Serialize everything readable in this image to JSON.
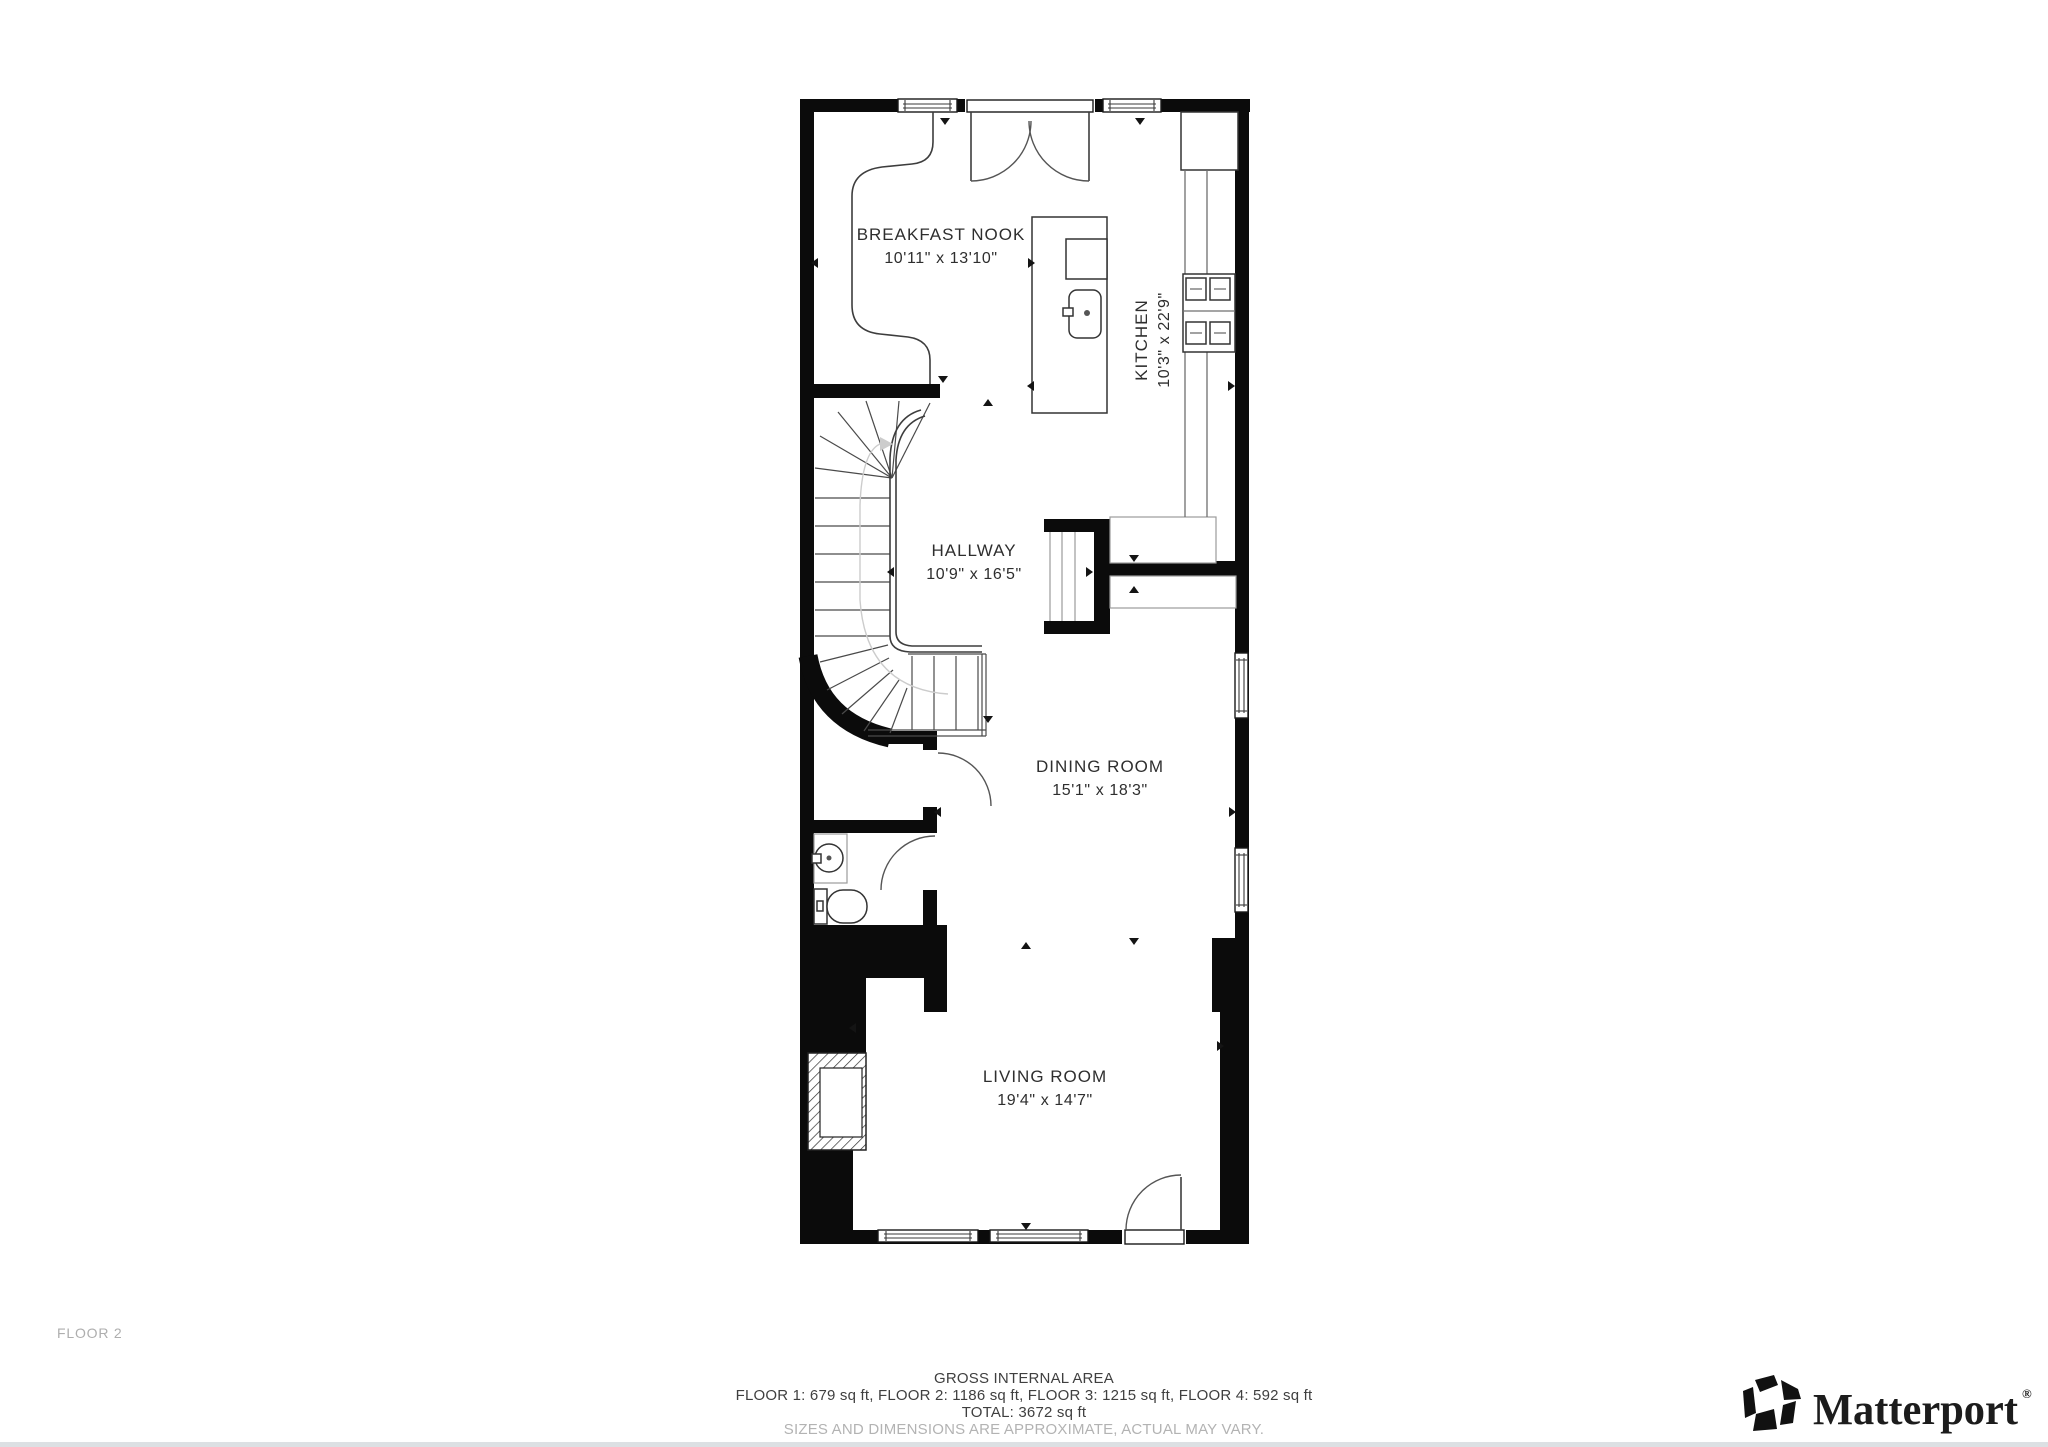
{
  "page": {
    "floor_label": "FLOOR 2"
  },
  "rooms": {
    "breakfast_nook": {
      "name": "BREAKFAST NOOK",
      "dims": "10'11\" x 13'10\""
    },
    "kitchen": {
      "name": "KITCHEN",
      "dims": "10'3\" x 22'9\""
    },
    "hallway": {
      "name": "HALLWAY",
      "dims": "10'9\" x 16'5\""
    },
    "dining_room": {
      "name": "DINING ROOM",
      "dims": "15'1\" x 18'3\""
    },
    "living_room": {
      "name": "LIVING ROOM",
      "dims": "19'4\" x 14'7\""
    }
  },
  "footer": {
    "title": "GROSS INTERNAL AREA",
    "floor_breakdown": "FLOOR 1: 679 sq ft, FLOOR 2: 1186 sq ft, FLOOR 3: 1215 sq ft, FLOOR 4: 592 sq ft",
    "total": "TOTAL: 3672 sq ft",
    "disclaimer": "SIZES AND DIMENSIONS ARE APPROXIMATE, ACTUAL MAY VARY."
  },
  "brand": {
    "wordmark": "Matterport",
    "registered_mark": "®"
  },
  "colors": {
    "wall": "#0b0b0b",
    "line": "#3d3d3d",
    "light_line": "#9b9b9b",
    "label_text": "#2e2e2e",
    "muted_text": "#b3b3b3",
    "page_bg": "#ffffff"
  }
}
